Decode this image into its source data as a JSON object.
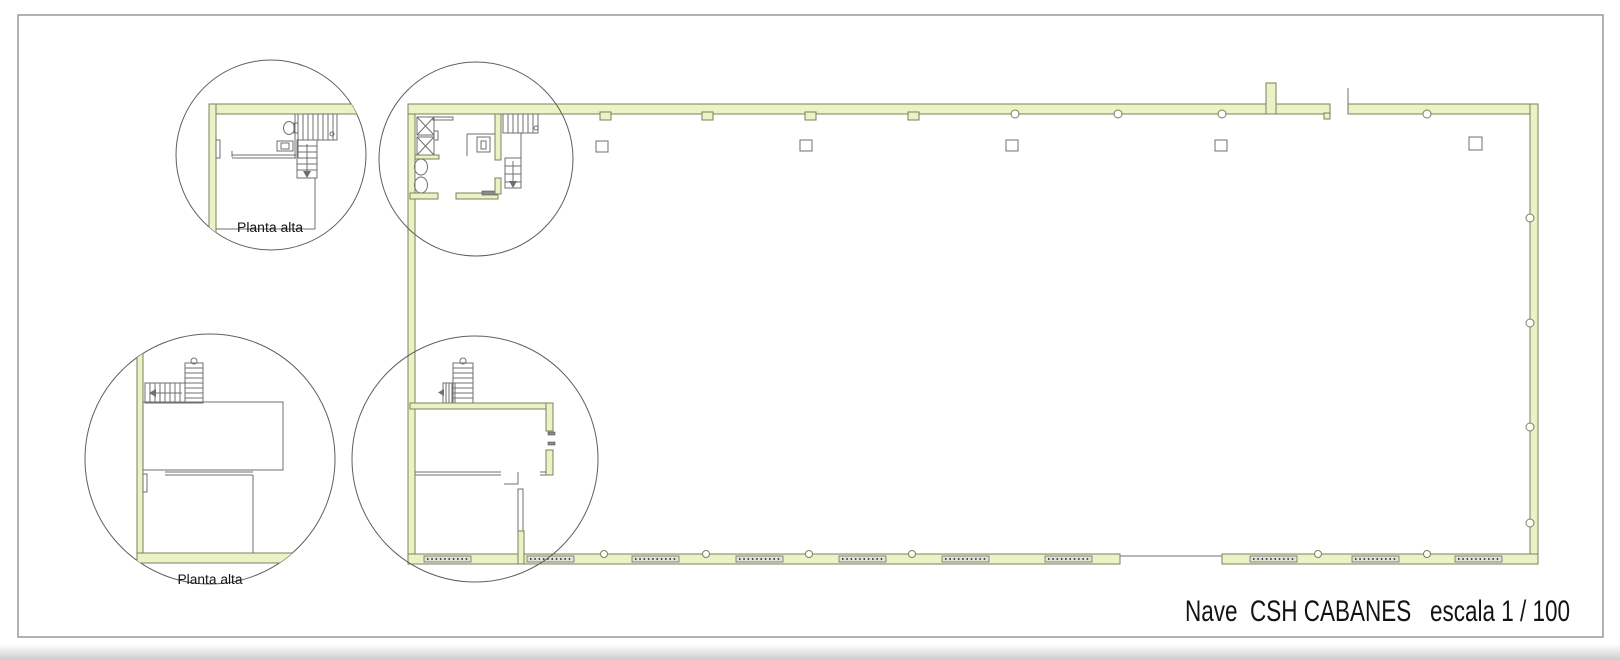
{
  "sheet": {
    "title": "Nave  CSH CABANES   escala 1 / 100"
  },
  "details": {
    "top": {
      "label": "Planta alta"
    },
    "bottom": {
      "label": "Planta alta"
    }
  },
  "colors": {
    "wall_fill": "#EBF2C5",
    "wall_stroke": "#7F7F5B",
    "line": "#6F6F6F",
    "detail_circle": "#5F5F5F",
    "glass_fill": "#E0E1D7",
    "glass_dots": "#4A4A4A",
    "text": "#141414",
    "border": "#999999",
    "background": "#FFFFFF"
  }
}
